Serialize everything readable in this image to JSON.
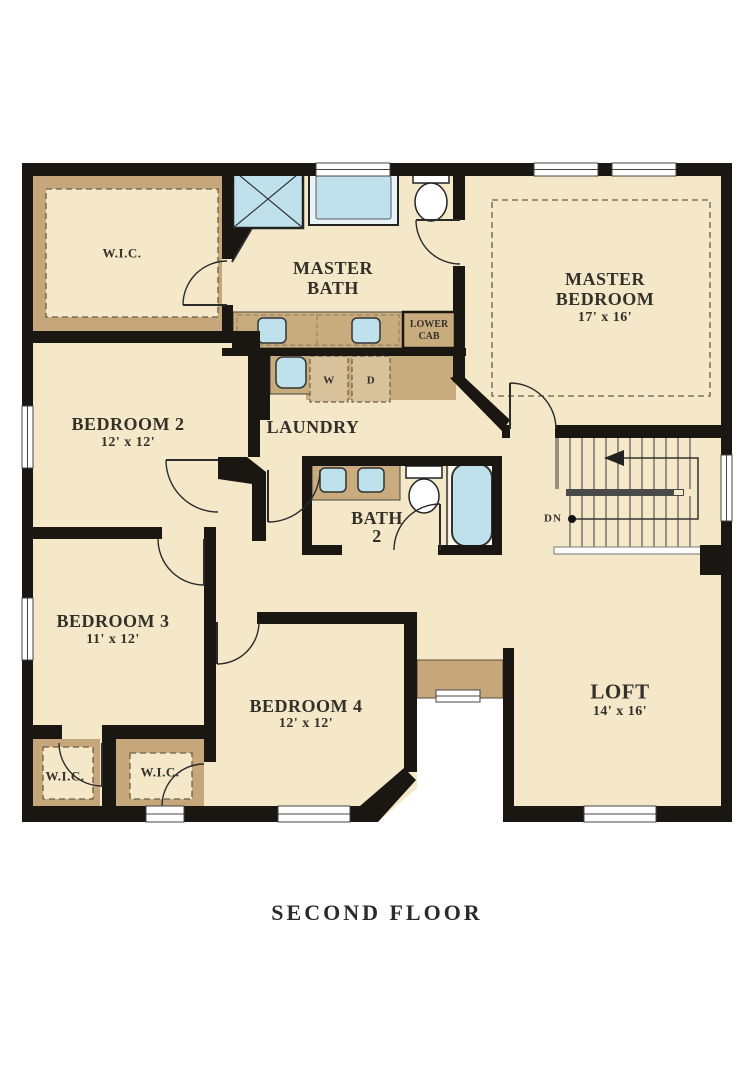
{
  "plan_title": "SECOND FLOOR",
  "colors": {
    "floor": "#F4E8C8",
    "cabinet_tan": "#C9AC7E",
    "band_tan": "#C6A77B",
    "fixture_blue": "#BEE1EC",
    "wall_black": "#1A1612",
    "dash_brown": "#6B5C45"
  },
  "rooms": {
    "wic_master": {
      "name": "W.I.C."
    },
    "master_bath": {
      "name_line1": "MASTER",
      "name_line2": "BATH"
    },
    "master_bedroom": {
      "name_line1": "MASTER",
      "name_line2": "BEDROOM",
      "dims": "17' x 16'"
    },
    "bedroom2": {
      "name": "BEDROOM 2",
      "dims": "12' x 12'"
    },
    "laundry": {
      "name": "LAUNDRY"
    },
    "bath2": {
      "name_line1": "BATH",
      "name_line2": "2"
    },
    "bedroom3": {
      "name": "BEDROOM 3",
      "dims": "11' x 12'"
    },
    "bedroom4": {
      "name": "BEDROOM 4",
      "dims": "12' x 12'"
    },
    "loft": {
      "name": "LOFT",
      "dims": "14' x 16'"
    },
    "wic_bedroom3": {
      "name": "W.I.C."
    },
    "wic_bedroom4": {
      "name": "W.I.C."
    }
  },
  "fixtures": {
    "washer_label": "W",
    "dryer_label": "D",
    "lower_cab_line1": "LOWER",
    "lower_cab_line2": "CAB",
    "stairs_direction": "DN"
  }
}
